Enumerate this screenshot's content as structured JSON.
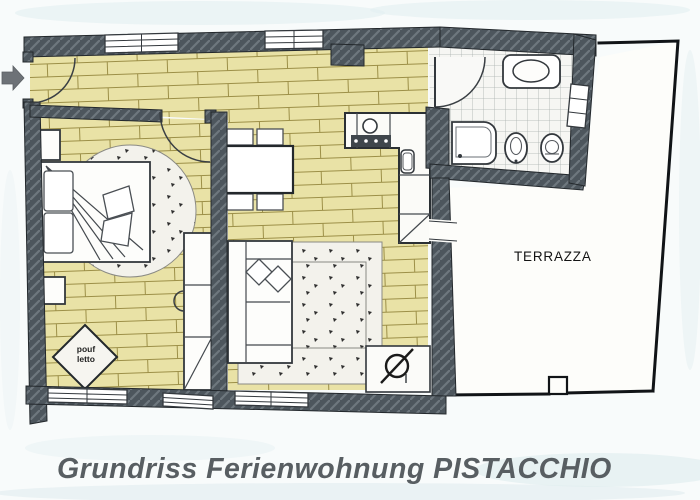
{
  "document": {
    "kind": "scanned floor plan",
    "title": "Grundriss Ferienwohnung PISTACCHIO"
  },
  "plan": {
    "terrace_label": "TERRAZZA",
    "pouf_label_line1": "pouf",
    "pouf_label_line2": "letto"
  },
  "icons": {
    "entry_arrow": "right-arrow"
  },
  "colors": {
    "paper": "#f8fbfb",
    "wall": "#4d565d",
    "wallHatch": "#6e777e",
    "parquet": "#e9e2a6",
    "parquetLine": "#9c8f47",
    "tileBg": "#f6f6f3",
    "tileLine": "#a9b0ae",
    "rugBg": "#f3f2ec",
    "speck": "#2f2f2f",
    "terraceBg": "#fdfdfa",
    "outline": "#23282c",
    "title": "#585e62",
    "arrow": "#6d7277"
  }
}
